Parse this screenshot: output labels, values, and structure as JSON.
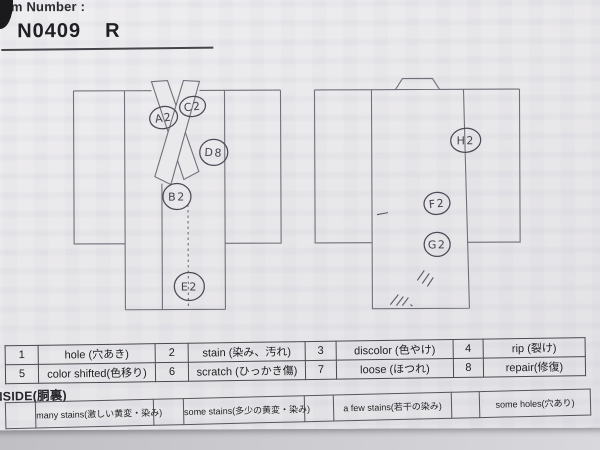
{
  "header": {
    "item_label": "Item Number :",
    "number": "N0409",
    "revision": "R"
  },
  "diagrams": {
    "front": {
      "view": "kimono-front",
      "annotations": [
        {
          "label": "A2"
        },
        {
          "label": "C2"
        },
        {
          "label": "D8"
        },
        {
          "label": "B2"
        },
        {
          "label": "E2"
        }
      ]
    },
    "back": {
      "view": "kimono-back",
      "annotations": [
        {
          "label": "H2"
        },
        {
          "label": "F2"
        },
        {
          "label": "G2"
        }
      ]
    }
  },
  "legend": {
    "rows": [
      {
        "cells": [
          {
            "num": "1",
            "label": "hole (穴あき)"
          },
          {
            "num": "2",
            "label": "stain (染み、汚れ)"
          },
          {
            "num": "3",
            "label": "discolor (色やけ)"
          },
          {
            "num": "4",
            "label": "rip (裂け)"
          }
        ]
      },
      {
        "cells": [
          {
            "num": "5",
            "label": "color shifted(色移り)"
          },
          {
            "num": "6",
            "label": "scratch (ひっかき傷)"
          },
          {
            "num": "7",
            "label": "loose (ほつれ)"
          },
          {
            "num": "8",
            "label": "repair(修復)"
          }
        ]
      }
    ]
  },
  "inside": {
    "title": "INSIDE(胴裏)",
    "options": [
      {
        "label": "many stains(激しい黄変・染み)"
      },
      {
        "label": "some stains(多少の黄変・染み)"
      },
      {
        "label": "a few stains(若干の染み)"
      },
      {
        "label": "some holes(穴あり)"
      }
    ]
  },
  "colors": {
    "paper": "#e9e8ea",
    "desk": "#cbcbd0",
    "diagram_line": "#70707a",
    "pencil": "#4e4957",
    "ink": "#222226"
  }
}
